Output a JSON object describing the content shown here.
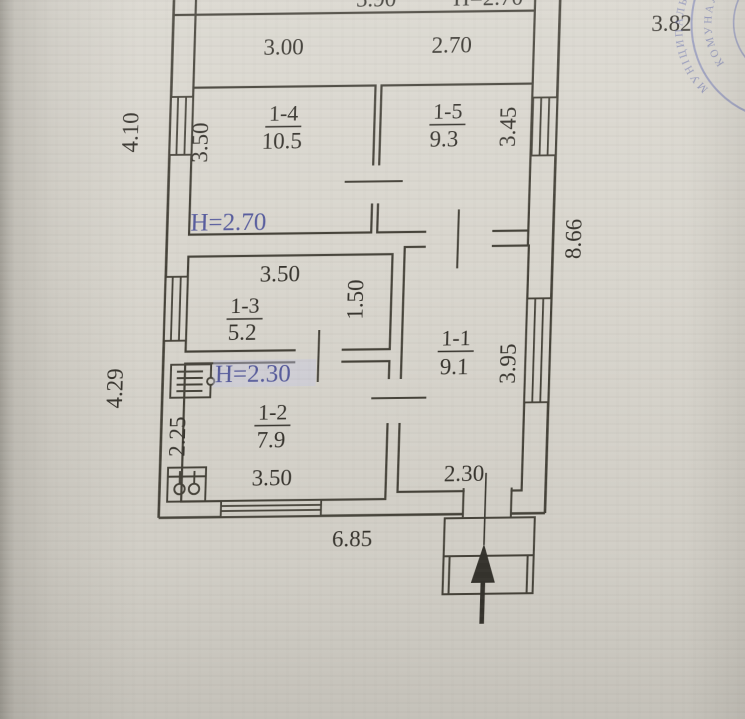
{
  "plan": {
    "title_hint": "floor-plan-scan",
    "outside_dims": {
      "top_right": "3.82",
      "right_side": "8.66",
      "left_upper": "4.10",
      "left_lower": "4.29",
      "bottom": "6.85"
    },
    "top_room_cut": {
      "dim": "5.90",
      "height_label": "H=2.70"
    },
    "rooms": [
      {
        "id": "1-4",
        "area": "10.5",
        "width": "3.00",
        "depth": "3.50",
        "height_label": "H=2.70"
      },
      {
        "id": "1-5",
        "area": "9.3",
        "width": "2.70",
        "depth": "3.45"
      },
      {
        "id": "1-3",
        "area": "5.2",
        "width": "3.50",
        "depth": "1.50"
      },
      {
        "id": "1-2",
        "area": "7.9",
        "width": "3.50",
        "depth": "2.25",
        "height_label": "H=2.30"
      },
      {
        "id": "1-1",
        "area": "9.1",
        "depth": "3.95",
        "entry_width": "2.30"
      }
    ],
    "stamp": {
      "text_outer": "МУНІЦИПАЛЬНОГО",
      "text_inner": "КОМУНАЛ"
    },
    "colors": {
      "paper": "#d9d6ce",
      "ink": "#3b3933",
      "height_label_blue": "#565b9d",
      "stamp_blue": "#6a73b5"
    }
  }
}
